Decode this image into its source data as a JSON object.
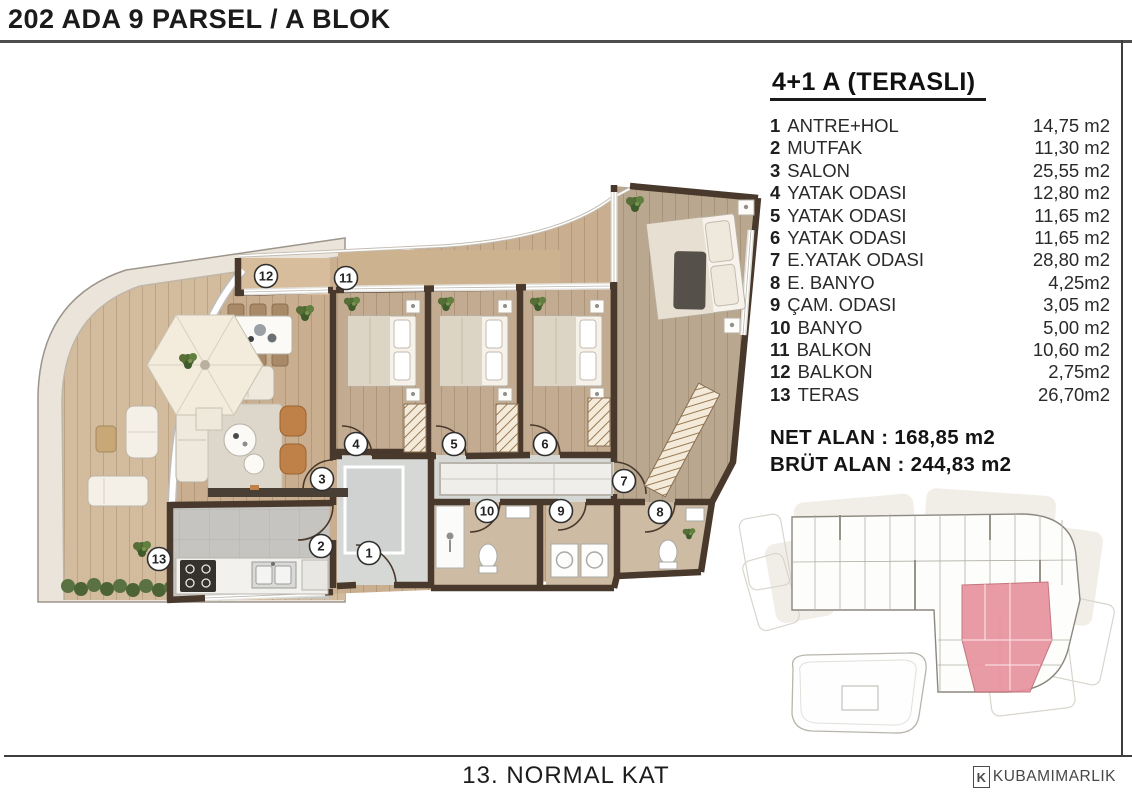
{
  "header": {
    "title": "202 ADA 9 PARSEL / A BLOK"
  },
  "unit_info": {
    "title": "4+1 A (TERASLI)",
    "rooms": [
      {
        "num": "1",
        "name": "ANTRE+HOL",
        "area": "14,75 m2"
      },
      {
        "num": "2",
        "name": "MUTFAK",
        "area": "11,30 m2"
      },
      {
        "num": "3",
        "name": "SALON",
        "area": "25,55 m2"
      },
      {
        "num": "4",
        "name": "YATAK ODASI",
        "area": "12,80 m2"
      },
      {
        "num": "5",
        "name": "YATAK ODASI",
        "area": "11,65 m2"
      },
      {
        "num": "6",
        "name": "YATAK ODASI",
        "area": "11,65 m2"
      },
      {
        "num": "7",
        "name": "E.YATAK ODASI",
        "area": "28,80 m2"
      },
      {
        "num": "8",
        "name": "E. BANYO",
        "area": "4,25m2"
      },
      {
        "num": "9",
        "name": "ÇAM. ODASI",
        "area": "3,05 m2"
      },
      {
        "num": "10",
        "name": "BANYO",
        "area": "5,00 m2"
      },
      {
        "num": "11",
        "name": "BALKON",
        "area": "10,60 m2"
      },
      {
        "num": "12",
        "name": "BALKON",
        "area": "2,75m2"
      },
      {
        "num": "13",
        "name": "TERAS",
        "area": "26,70m2"
      }
    ],
    "net_alan": "NET ALAN : 168,85 m2",
    "brut_alan": "BRÜT ALAN : 244,83 m2"
  },
  "plan": {
    "markers": [
      "1",
      "2",
      "3",
      "4",
      "5",
      "6",
      "7",
      "8",
      "9",
      "10",
      "11",
      "12",
      "13"
    ]
  },
  "footer": {
    "floor_label": "13. NORMAL KAT",
    "logo_k": "K",
    "logo_text": "KUBAMIMARLIK"
  },
  "colors": {
    "wall": "#49392c",
    "wood_floor": "#c9af8f",
    "terrace_floor": "#d3bc9e",
    "tile_floor": "#c5c4c0",
    "bath_floor": "#cdbba4",
    "highlight_unit": "#e8939e"
  }
}
